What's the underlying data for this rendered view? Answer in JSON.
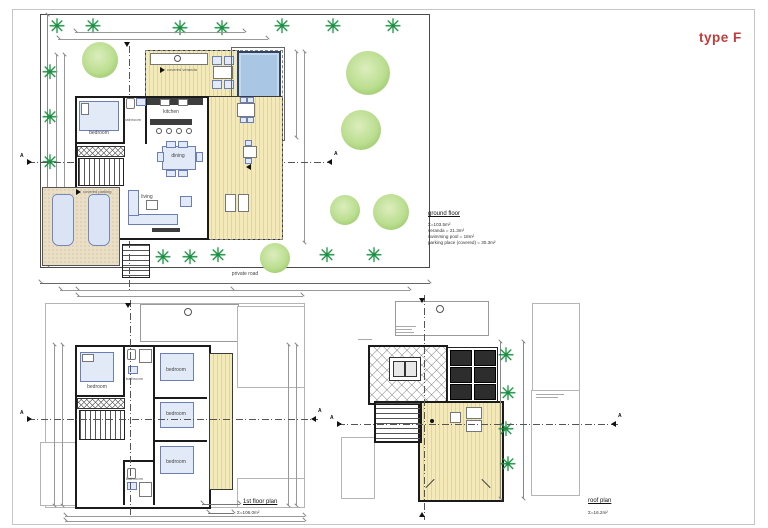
{
  "title": "type F",
  "sheet": {
    "ground_floor": {
      "title": "ground floor",
      "stats": [
        "Σ=103.5m²",
        "veranda = 21.3m²",
        "swimming pool = 18m²",
        "parking place (covered) = 30.3m²"
      ],
      "labels": {
        "bedroom": "bedroom",
        "bathroom": "bathroom",
        "kitchen": "kitchen",
        "dining": "dining",
        "living": "living",
        "covered_veranda": "covered veranda",
        "covered_parking": "covered parking",
        "private_road": "private road"
      },
      "section_marker": "A"
    },
    "first_floor": {
      "title": "1st floor plan",
      "area": "Σ=106.0m²",
      "labels": {
        "bedroom": "bedroom",
        "bathroom": "bathroom"
      },
      "section_marker": "A"
    },
    "roof_plan": {
      "title": "roof plan",
      "area": "Σ=16.2m²",
      "section_marker": "A"
    }
  },
  "icons": {
    "palm_tree": "✳"
  },
  "colors": {
    "accent_red": "#c23b3b",
    "deck_yellow": "#efe5b8",
    "pool_blue": "#a9c6e5",
    "palm_green": "#179141",
    "bush_green": "#b9dd8c",
    "parking_beige": "#eadfc6",
    "wall_black": "#1b1b1b"
  }
}
